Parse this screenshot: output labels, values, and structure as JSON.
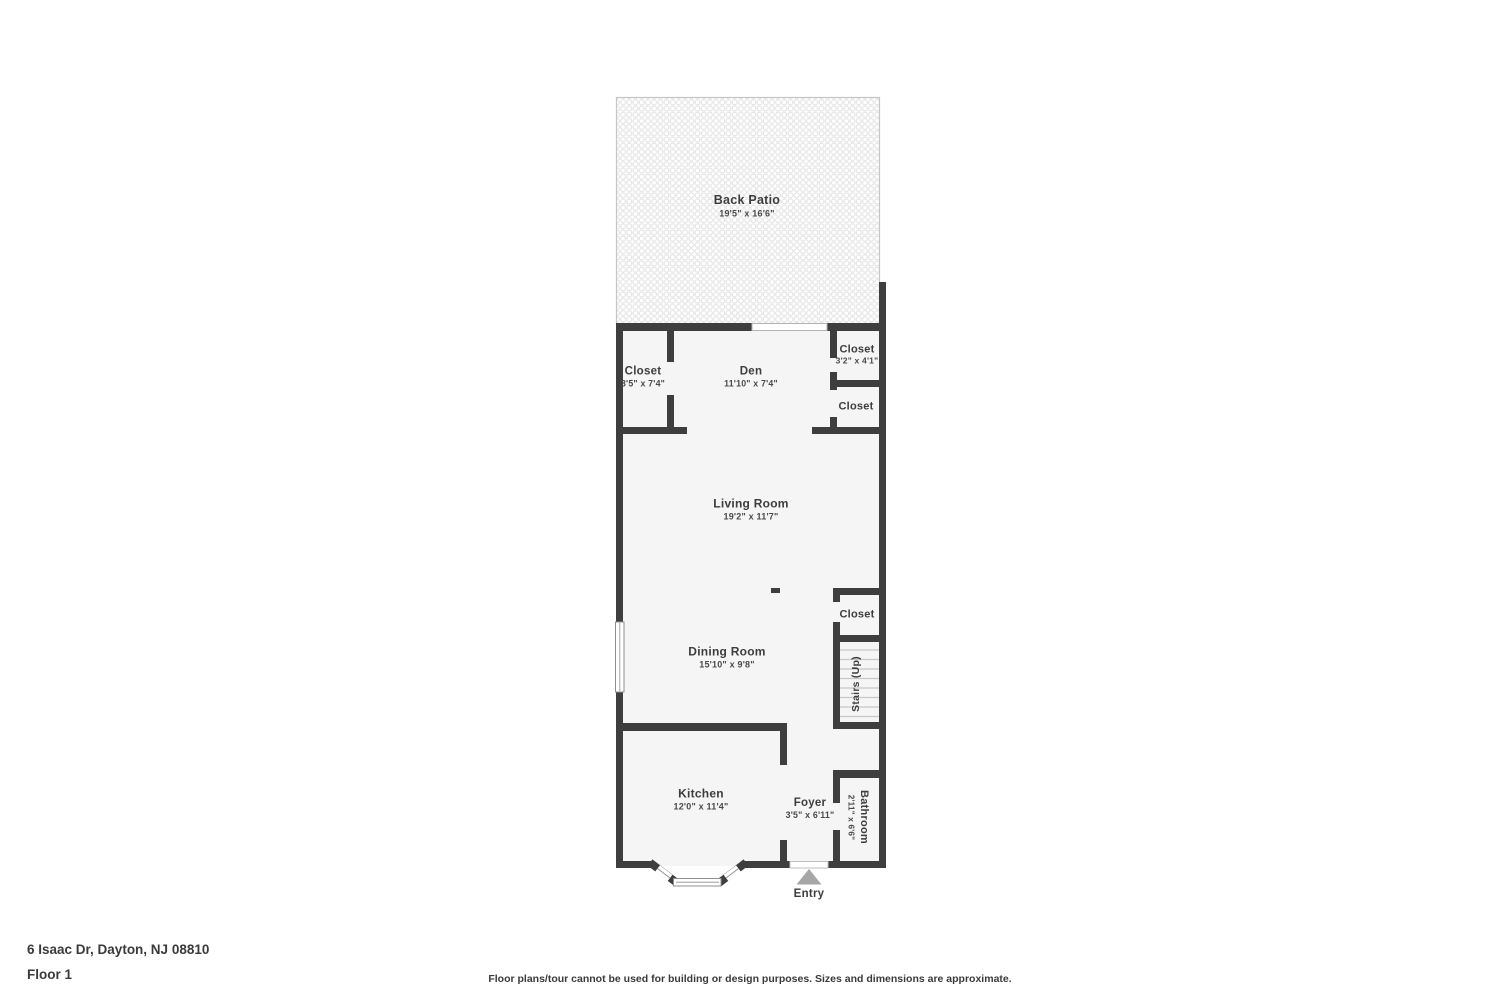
{
  "address": "6 Isaac Dr, Dayton, NJ 08810",
  "floor_label": "Floor 1",
  "disclaimer": "Floor plans/tour cannot be used for building or design purposes. Sizes and dimensions are approximate.",
  "entry_label": "Entry",
  "rooms": {
    "back_patio": {
      "name": "Back Patio",
      "dims": "19'5\" x 16'6\""
    },
    "closet_left": {
      "name": "Closet",
      "dims": "3'5\" x 7'4\""
    },
    "den": {
      "name": "Den",
      "dims": "11'10\" x 7'4\""
    },
    "closet_top_right": {
      "name": "Closet",
      "dims": "3'2\" x 4'1\""
    },
    "closet_right_2": {
      "name": "Closet"
    },
    "living_room": {
      "name": "Living Room",
      "dims": "19'2\" x 11'7\""
    },
    "closet_mid_right": {
      "name": "Closet"
    },
    "stairs": {
      "name": "Stairs (Up)"
    },
    "dining_room": {
      "name": "Dining Room",
      "dims": "15'10\" x 9'8\""
    },
    "kitchen": {
      "name": "Kitchen",
      "dims": "12'0\" x 11'4\""
    },
    "foyer": {
      "name": "Foyer",
      "dims": "3'5\" x 6'11\""
    },
    "bathroom": {
      "name": "Bathroom",
      "dims": "2'11\" x 6'6\""
    }
  },
  "colors": {
    "wall": "#3e3e3e",
    "floor": "#f5f5f5",
    "patio_tile": "#e3e3e3",
    "patio_border": "#c6c6c6",
    "label": "#3d3d3d",
    "dims": "#4a4a4a",
    "tread": "#c8c8c8",
    "arrow": "#a6a6a6",
    "window_frame": "#8f8f8f"
  }
}
